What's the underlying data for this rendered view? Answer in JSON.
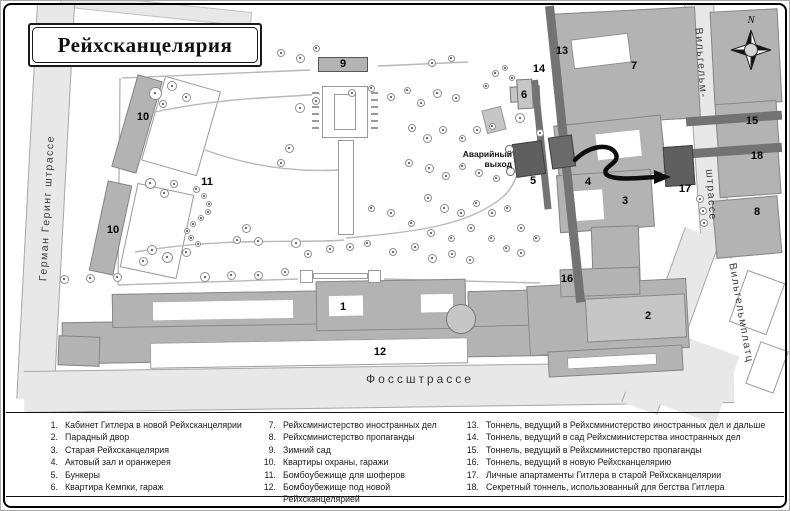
{
  "title": "Рейхсканцелярия",
  "compass": {
    "north_label": "N"
  },
  "map": {
    "emergency_exit_label": "Аварийный выход",
    "streets": [
      {
        "id": "german-goering",
        "label": "Герман Геринг штрассе"
      },
      {
        "id": "voss",
        "label": "Фоссштрассе"
      },
      {
        "id": "wilhelm-line1",
        "label": "Вильгельм-"
      },
      {
        "id": "wilhelm-line2",
        "label": "штрассе"
      },
      {
        "id": "wilhelmplatz",
        "label": "Вильгельмплатц"
      }
    ],
    "markers": [
      {
        "n": "1",
        "x": 343,
        "y": 307
      },
      {
        "n": "2",
        "x": 648,
        "y": 316
      },
      {
        "n": "3",
        "x": 625,
        "y": 201
      },
      {
        "n": "4",
        "x": 588,
        "y": 182
      },
      {
        "n": "5",
        "x": 533,
        "y": 181
      },
      {
        "n": "6",
        "x": 524,
        "y": 95
      },
      {
        "n": "7",
        "x": 634,
        "y": 66
      },
      {
        "n": "8",
        "x": 757,
        "y": 212
      },
      {
        "n": "9",
        "x": 343,
        "y": 64
      },
      {
        "n": "10",
        "x": 143,
        "y": 117
      },
      {
        "n": "10",
        "x": 113,
        "y": 230
      },
      {
        "n": "11",
        "x": 207,
        "y": 182
      },
      {
        "n": "12",
        "x": 380,
        "y": 352
      },
      {
        "n": "13",
        "x": 562,
        "y": 51
      },
      {
        "n": "14",
        "x": 539,
        "y": 69
      },
      {
        "n": "15",
        "x": 752,
        "y": 121
      },
      {
        "n": "16",
        "x": 567,
        "y": 279
      },
      {
        "n": "17",
        "x": 685,
        "y": 189
      },
      {
        "n": "18",
        "x": 757,
        "y": 156
      }
    ],
    "trees": [
      [
        155,
        93,
        13
      ],
      [
        172,
        86,
        10
      ],
      [
        186,
        97,
        9
      ],
      [
        163,
        104,
        8
      ],
      [
        150,
        183,
        11
      ],
      [
        164,
        193,
        9
      ],
      [
        174,
        184,
        8
      ],
      [
        152,
        250,
        10
      ],
      [
        143,
        261,
        9
      ],
      [
        167,
        257,
        11
      ],
      [
        186,
        252,
        9
      ],
      [
        205,
        277,
        10
      ],
      [
        231,
        275,
        9
      ],
      [
        258,
        275,
        9
      ],
      [
        64,
        279,
        9
      ],
      [
        90,
        278,
        9
      ],
      [
        117,
        277,
        9
      ],
      [
        246,
        228,
        9
      ],
      [
        258,
        241,
        9
      ],
      [
        237,
        240,
        8
      ],
      [
        300,
        108,
        10
      ],
      [
        316,
        101,
        8
      ],
      [
        289,
        148,
        9
      ],
      [
        281,
        163,
        8
      ],
      [
        296,
        243,
        10
      ],
      [
        308,
        254,
        8
      ],
      [
        330,
        249,
        8
      ],
      [
        285,
        272,
        8
      ],
      [
        350,
        247,
        8
      ],
      [
        367,
        243,
        7
      ],
      [
        393,
        252,
        8
      ],
      [
        415,
        247,
        8
      ],
      [
        432,
        258,
        9
      ],
      [
        452,
        254,
        8
      ],
      [
        470,
        260,
        8
      ],
      [
        352,
        93,
        8
      ],
      [
        371,
        88,
        7
      ],
      [
        391,
        97,
        8
      ],
      [
        407,
        90,
        7
      ],
      [
        421,
        103,
        8
      ],
      [
        437,
        93,
        9
      ],
      [
        456,
        98,
        8
      ],
      [
        412,
        128,
        8
      ],
      [
        427,
        138,
        9
      ],
      [
        443,
        130,
        8
      ],
      [
        462,
        138,
        7
      ],
      [
        477,
        130,
        8
      ],
      [
        492,
        126,
        7
      ],
      [
        409,
        163,
        8
      ],
      [
        429,
        168,
        9
      ],
      [
        446,
        176,
        8
      ],
      [
        462,
        166,
        7
      ],
      [
        479,
        173,
        8
      ],
      [
        496,
        178,
        7
      ],
      [
        428,
        198,
        8
      ],
      [
        444,
        208,
        9
      ],
      [
        461,
        213,
        8
      ],
      [
        476,
        203,
        7
      ],
      [
        492,
        213,
        8
      ],
      [
        507,
        208,
        7
      ],
      [
        371,
        208,
        7
      ],
      [
        391,
        213,
        8
      ],
      [
        411,
        223,
        7
      ],
      [
        431,
        233,
        8
      ],
      [
        451,
        238,
        7
      ],
      [
        471,
        228,
        8
      ],
      [
        491,
        238,
        7
      ],
      [
        506,
        248,
        7
      ],
      [
        521,
        253,
        8
      ],
      [
        536,
        238,
        7
      ],
      [
        521,
        228,
        8
      ],
      [
        300,
        58,
        9
      ],
      [
        281,
        53,
        8
      ],
      [
        316,
        48,
        7
      ],
      [
        432,
        63,
        8
      ],
      [
        451,
        58,
        7
      ],
      [
        495,
        73,
        7
      ],
      [
        505,
        68,
        6
      ],
      [
        512,
        78,
        6
      ],
      [
        486,
        86,
        6
      ],
      [
        520,
        118,
        10
      ],
      [
        540,
        133,
        8
      ],
      [
        196,
        189,
        7
      ],
      [
        204,
        196,
        6
      ],
      [
        209,
        204,
        6
      ],
      [
        208,
        212,
        6
      ],
      [
        201,
        218,
        6
      ],
      [
        193,
        224,
        6
      ],
      [
        187,
        231,
        6
      ],
      [
        191,
        238,
        6
      ],
      [
        198,
        244,
        6
      ],
      [
        700,
        199,
        8
      ],
      [
        703,
        211,
        8
      ],
      [
        704,
        223,
        8
      ]
    ]
  },
  "legend": {
    "columns": [
      [
        {
          "n": "1.",
          "text": "Кабинет Гитлера в новой Рейхсканцелярии"
        },
        {
          "n": "2.",
          "text": "Парадный двор"
        },
        {
          "n": "3.",
          "text": "Старая Рейхсканцелярия"
        },
        {
          "n": "4.",
          "text": "Актовый зал и оранжерея"
        },
        {
          "n": "5.",
          "text": "Бункеры"
        },
        {
          "n": "6.",
          "text": "Квартира Кемпки, гараж"
        }
      ],
      [
        {
          "n": "7.",
          "text": "Рейхсминистерство иностранных дел"
        },
        {
          "n": "8.",
          "text": "Рейхсминистерство пропаганды"
        },
        {
          "n": "9.",
          "text": "Зимний сад"
        },
        {
          "n": "10.",
          "text": "Квартиры охраны, гаражи"
        },
        {
          "n": "11.",
          "text": "Бомбоубежище для шоферов"
        },
        {
          "n": "12.",
          "text": "Бомбоубежище под новой Рейхсканцелярией"
        }
      ],
      [
        {
          "n": "13.",
          "text": "Тоннель, ведущий в Рейхсминистерство иностранных дел и дальше"
        },
        {
          "n": "14.",
          "text": "Тоннель, ведущий в сад Рейхсминистерства иностранных дел"
        },
        {
          "n": "15.",
          "text": "Тоннель, ведущий в Рейхсминистерство пропаганды"
        },
        {
          "n": "16.",
          "text": "Тоннель, ведущий в новую Рейхсканцелярию"
        },
        {
          "n": "17.",
          "text": "Личные апартаменты Гитлера в старой Рейхсканцелярии"
        },
        {
          "n": "18.",
          "text": "Секретный тоннель, использованный для бегства Гитлера"
        }
      ]
    ]
  }
}
